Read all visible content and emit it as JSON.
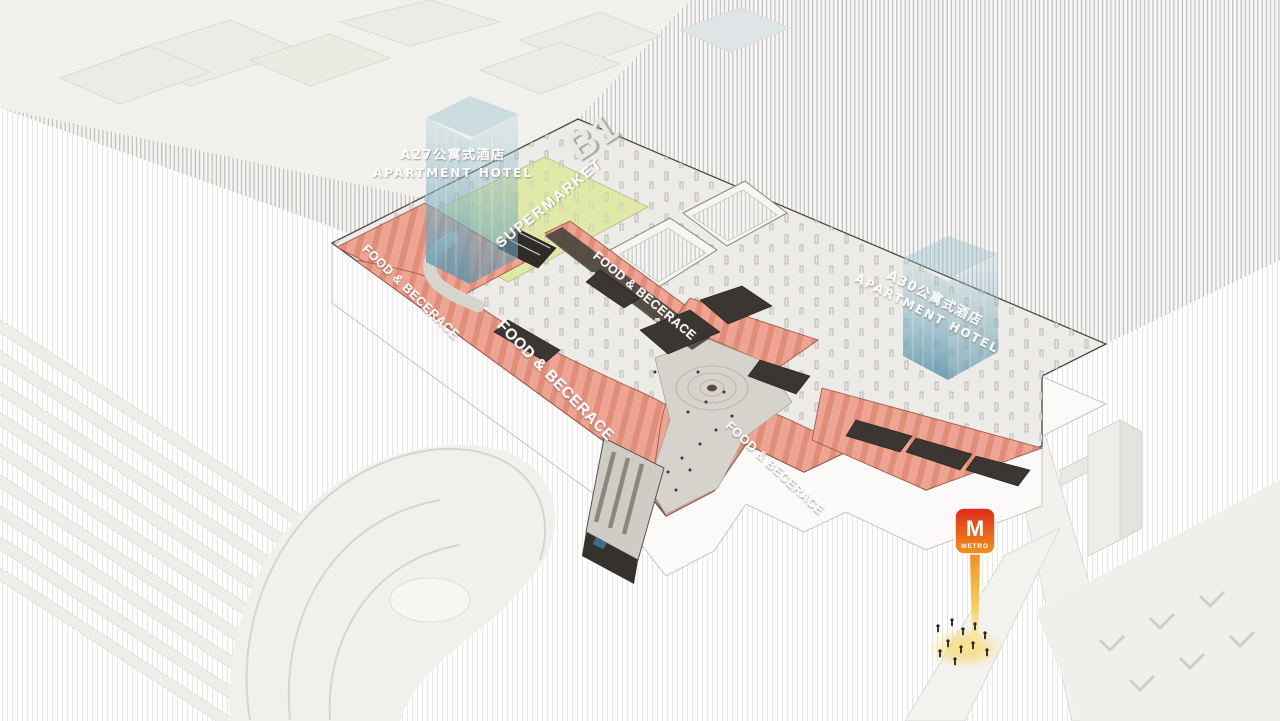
{
  "diagram": {
    "floor_label": "B1",
    "zone_labels": {
      "food_beverage": "FOOD & BECERACE",
      "supermarket": "SUPERMARKET"
    },
    "hotel_a27": {
      "line1_zh": "A27公寓式酒店",
      "line2_en": "APARTMENT HOTEL"
    },
    "hotel_a30": {
      "line1_zh": "A30公寓式酒店",
      "line2_en": "APARTMENT HOTEL"
    },
    "metro": {
      "initial": "M",
      "caption": "METRO"
    },
    "colors": {
      "food_beverage": "#eda493",
      "food_beverage_stripe": "#e08d79",
      "supermarket": "#dfe8a6",
      "hotel_tower": "#7fb3c6",
      "metro_red": "#df2b1c",
      "metro_orange": "#f2921c",
      "beam_yellow": "#f7cf4a",
      "plate_top": "#edebe7",
      "dark_roof": "#3b3631"
    }
  }
}
